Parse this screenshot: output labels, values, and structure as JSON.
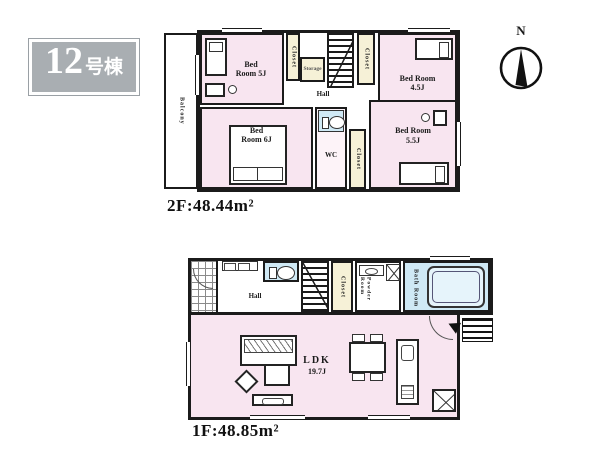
{
  "building": {
    "number": "12",
    "suffix": "号棟"
  },
  "compass": {
    "north": "N"
  },
  "floor2": {
    "area_label": "2F:48.44m²",
    "balcony_label": "Balcony",
    "hall_label": "Hall",
    "storage_label": "Storage",
    "closet_label": "Closet",
    "wc_label": "WC",
    "bedroom_nw_label": "Bed Room 5J",
    "bedroom_ne_label": "Bed Room 4.5J",
    "bedroom_sw_label": "Bed Room 6J",
    "bedroom_se_label": "Bed Room 5.5J"
  },
  "floor1": {
    "area_label": "1F:48.85m²",
    "hall_label": "Hall",
    "closet_label": "Closet",
    "powder_room_label": "Powder Room",
    "bath_room_label": "Bath Room",
    "ldk_label": "LDK",
    "ldk_size_label": "19.7J"
  },
  "colors": {
    "room_pink": "#f8e5f0",
    "closet_cream": "#f6f1d7",
    "water_blue": "#cfe9f5",
    "wall": "#1b1b1b",
    "badge_gray": "#a9aeb2"
  }
}
